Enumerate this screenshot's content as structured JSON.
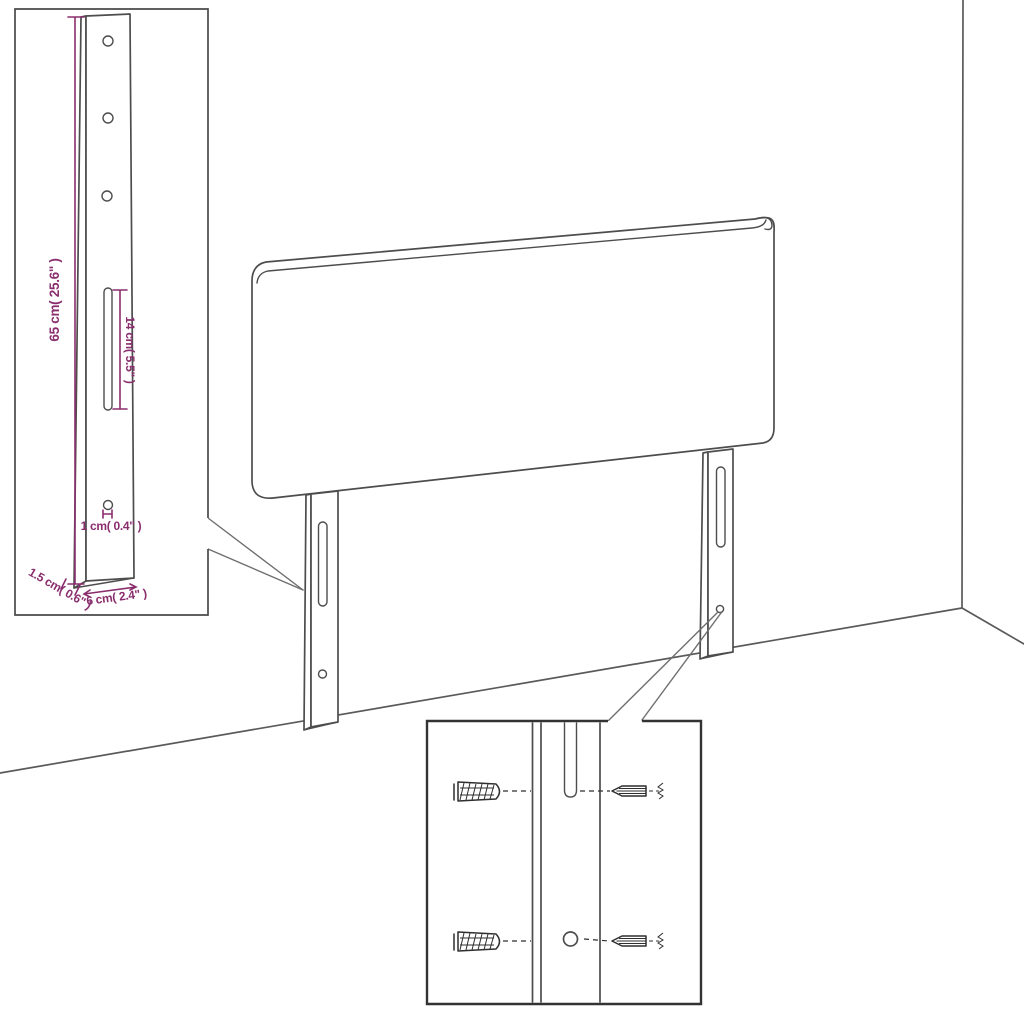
{
  "labels": {
    "leg_height": "65 cm( 25.6\" )",
    "slot_length": "14 cm( 5.5\" )",
    "hole_diameter": "1 cm( 0.4\" )",
    "leg_depth": "1.5 cm( 0.6\" )",
    "leg_width": "6 cm( 2.4\" )"
  },
  "colors": {
    "dimension": "#8A2E6E",
    "outline": "#4d4d4d",
    "room": "#5a5a5a",
    "wedge": "#6f6f6f",
    "inset_border_light": "#4a4a4a",
    "inset_border_dark": "#333333",
    "hardware": "#2f2f2f",
    "background": "#ffffff"
  }
}
